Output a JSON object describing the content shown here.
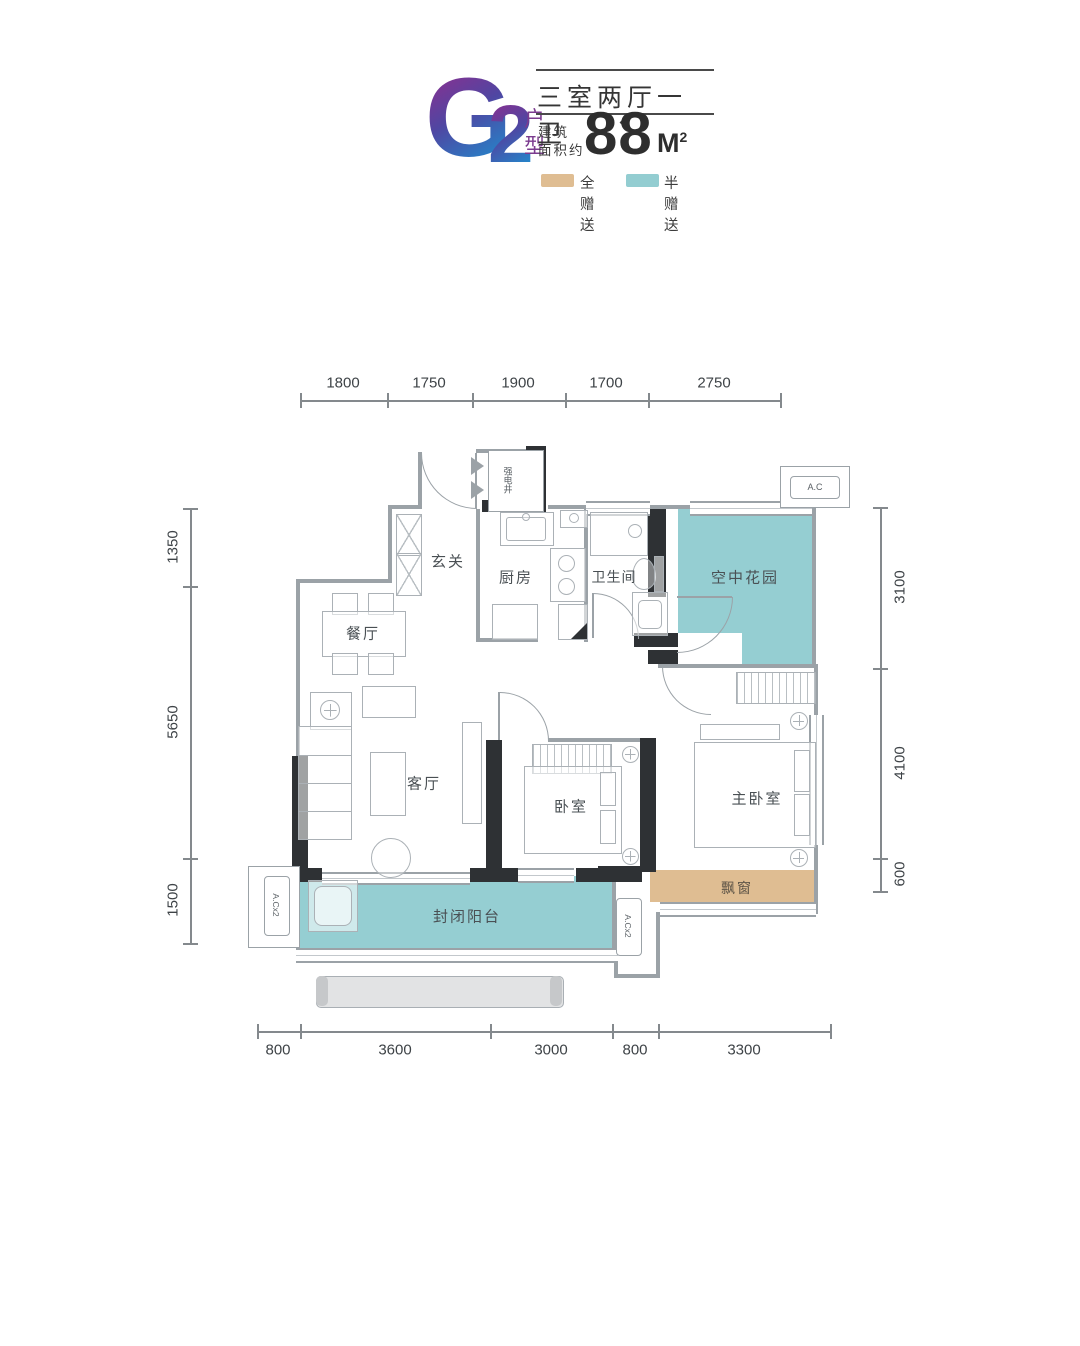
{
  "header": {
    "unit_code_letter": "G",
    "unit_code_number": "2",
    "unit_suffix_char1": "户",
    "unit_suffix_char2": "型",
    "title": "三室两厅一卫",
    "area_label_line1": "建筑",
    "area_label_line2": "面积约",
    "area_value": "88",
    "area_unit": "M",
    "area_unit_exponent": "2",
    "legend": [
      {
        "label": "全赠送",
        "color": "#dfbd92"
      },
      {
        "label": "半赠送",
        "color": "#93cdd1"
      }
    ]
  },
  "rooms": {
    "entry": "玄关",
    "kitchen": "厨房",
    "bathroom": "卫生间",
    "sky_garden": "空中花园",
    "dining": "餐厅",
    "living": "客厅",
    "bedroom": "卧室",
    "master_bedroom": "主卧室",
    "balcony": "封闭阳台",
    "bay_window": "飘窗"
  },
  "annotations": {
    "shaft": "强电井",
    "ac_top": "A.C",
    "ac_left": "A.Cx2",
    "ac_bottom": "A.Cx2"
  },
  "dimensions": {
    "top": [
      "1800",
      "1750",
      "1900",
      "1700",
      "2750"
    ],
    "left": [
      "1350",
      "5650",
      "1500"
    ],
    "right": [
      "3100",
      "4100",
      "600"
    ],
    "bottom": [
      "800",
      "3600",
      "3000",
      "800",
      "3300"
    ]
  },
  "colors": {
    "full_gift_tan": "#dfbd92",
    "half_gift_teal": "#95ced2",
    "wall_black": "#2e3134",
    "wall_gray": "#9ba2a7",
    "accent_purple": "#8d2f8f",
    "accent_blue": "#1e8fd0"
  }
}
